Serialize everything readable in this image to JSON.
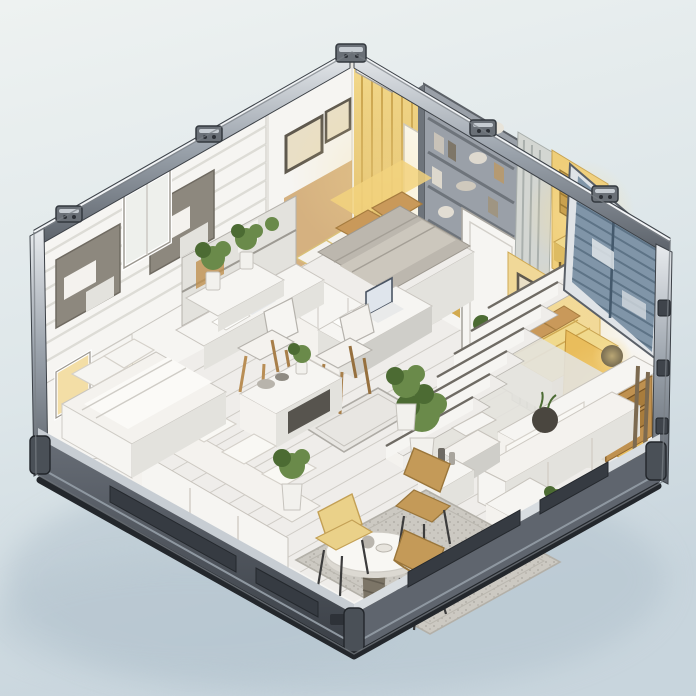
{
  "meta": {
    "type": "isometric-illustration",
    "subject": "Cutaway view of a shipping-container tiny home interior",
    "width_px": 696,
    "height_px": 696,
    "visible_text": ""
  },
  "scene": {
    "description": "Isometric cutaway illustration of a multi-room container house: white slatted facades and metal container frame, warm yellow lofted bedrooms with gold curtains, a tall bookshelf, central staircase, desks with laptops, white sofas and coffee table, many potted plants, and a round dining table with three tan chairs on a gray rug over whitewashed plank flooring, all resting on a dark container base with a pale blue-gray backdrop.",
    "objects": [
      "container-frame",
      "roof-rails",
      "corner-castings",
      "left-slatted-facade",
      "facade-window",
      "plant-ledge",
      "upper-left-bedroom",
      "gold-curtains",
      "air-conditioner",
      "framed-pictures",
      "tall-bookshelf",
      "white-door-partition",
      "gray-curtain",
      "upper-right-sleeping-nook",
      "center-loft-bed",
      "right-bedroom-nook",
      "dresser-with-lamp",
      "blue-louver-shutters",
      "staircase",
      "built-in-desk",
      "desk-laptop",
      "white-desk-chair",
      "center-work-table",
      "table-laptop",
      "wooden-chair",
      "coffee-table",
      "left-sectional-sofa",
      "right-sofa",
      "lounge-chair",
      "side-table",
      "white-cabinet",
      "potted-shrubs",
      "floor-hatch",
      "area-rug",
      "round-dining-table",
      "dining-chairs",
      "left-bedroom-white-bed",
      "wall-lamp",
      "container-base"
    ]
  },
  "colors": {
    "bg_top": "#ecf1f1",
    "bg_bottom": "#cbd7de",
    "ground_shadow": "#b3c3ce",
    "wall_white": "#f6f5f2",
    "wall_shade": "#e3e2dd",
    "wall_dark": "#cfcec9",
    "floor_light": "#efedea",
    "floor_line": "#cfccc6",
    "metal_light": "#dfe3e7",
    "metal_mid": "#9aa2ab",
    "metal_dark": "#4e545c",
    "base_dark": "#545a62",
    "base_mid": "#5f656e",
    "base_darker": "#363b42",
    "base_light": "#c7cdd3",
    "gold_curtain": "#e5c167",
    "gold_dark": "#c49b43",
    "gold_light": "#f6e3a6",
    "bed_yellow": "#f0d98d",
    "bed_yellow_dark": "#ddbb62",
    "bed_white": "#f4f2ee",
    "bed_gray": "#bcb7ae",
    "pillow_tan": "#c9995a",
    "warm_glow": "#f2d27e",
    "warm_deep": "#e2ab45",
    "wood": "#bf9150",
    "wood_dark": "#8f6730",
    "shutter_blue": "#8095a8",
    "shutter_dark": "#5d7386",
    "plant_green": "#6a8a4a",
    "plant_dark": "#4c6b33",
    "pot_white": "#f2f1ed",
    "rug_gray": "#cac7c0",
    "rug_dot": "#b2afa7",
    "chair_yellow": "#ead189",
    "chair_tan": "#c49a58",
    "leg_dark": "#3c3c3c",
    "laptop_screen": "#39414d",
    "line_gray": "#b2afa9",
    "frame_line": "#6f757c"
  }
}
